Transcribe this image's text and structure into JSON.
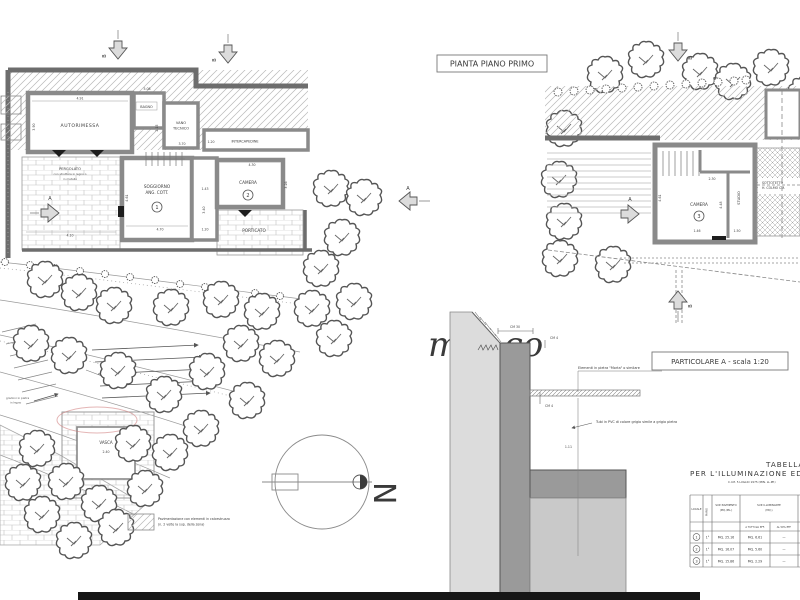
{
  "page": {
    "plan_title": "PIANTA PIANO PRIMO",
    "detail_title": "PARTICOLARE A - scala 1:20",
    "watermark": "mu, co",
    "north": "N",
    "part_label": "PART. \"A\""
  },
  "left_plan": {
    "rooms": {
      "autorimessa": "AUTORIMESSA",
      "bagno": "BAGNO",
      "vano1": "VANO",
      "vano2": "TECNICO",
      "intercapedine": "INTERCAPEDINE",
      "soggiorno1": "SOGGIORNO",
      "soggiorno2": "ANG. COTT.",
      "soggiorno_num": "1",
      "camera": "CAMERA",
      "camera_num": "2",
      "porticato": "PORTICATO",
      "pergolato1": "PERGOLATO",
      "pergolato2": "con struttura in legno o",
      "pergolato3": "in metallo",
      "vasca": "VASCA"
    },
    "dims": [
      "4.91",
      "3.90",
      "5.08",
      "2.15",
      "3.70",
      "1.20",
      "4.61",
      "1.43",
      "3.40",
      "4.30",
      "3.26",
      "4.70",
      "1.20",
      "4.10",
      "2.40"
    ],
    "notes": {
      "steps1": "gradoni in pietra",
      "steps2": "in legno"
    }
  },
  "right_plan": {
    "rooms": {
      "camera": "CAMERA",
      "camera_num": "3",
      "studio": "STUDIO",
      "sottotetto1": "SOTTOTETTO",
      "sottotetto2": "H. COLMO CM."
    },
    "dims": [
      "2.30",
      "4.48",
      "1.46",
      "1.50",
      "4.61"
    ]
  },
  "detail": {
    "dims": [
      "CM 30",
      "CM 4",
      "CM 4",
      "1.11"
    ],
    "note1": "Elementi in pietra \"Morta\" o similare",
    "note2": "Tubi in PVC di colore grigio simile a grigio pietra"
  },
  "markers": {
    "a": "A",
    "b": "B"
  },
  "legend": {
    "line1": "Pavimentazione con elementi in calcestruzzo",
    "line2": "(n. 2 volte la sup. della zona)"
  },
  "table": {
    "title1": "TABELLA",
    "title2": "PER L'ILLUMINAZIONE ED AERAZIONE",
    "subtitle": "C.I.M. 5 LUGLIO 1975 (MIN. LL.PP.)",
    "headers": {
      "c1": "LOCALE",
      "c2": "PIANO",
      "c3a": "SUP. PAVIMENTO",
      "c3b": "(MQ./ML.)",
      "c4a": "SUP. ILLUMINANTE",
      "c4b": "(MQ.)",
      "s1": "A TUTTI GLI EFF.",
      "s2": "AL 50% EFF."
    },
    "rows": [
      {
        "n": "1",
        "floor": "1°",
        "pav": "MQ. 25.16",
        "ill": "MQ. 6.61",
        "extra": "—"
      },
      {
        "n": "2",
        "floor": "1°",
        "pav": "MQ. 16.07",
        "ill": "MQ. 5.60",
        "extra": "—"
      },
      {
        "n": "3",
        "floor": "1°",
        "pav": "MQ. 15.86",
        "ill": "MQ. 2.29",
        "extra": "—"
      }
    ]
  }
}
